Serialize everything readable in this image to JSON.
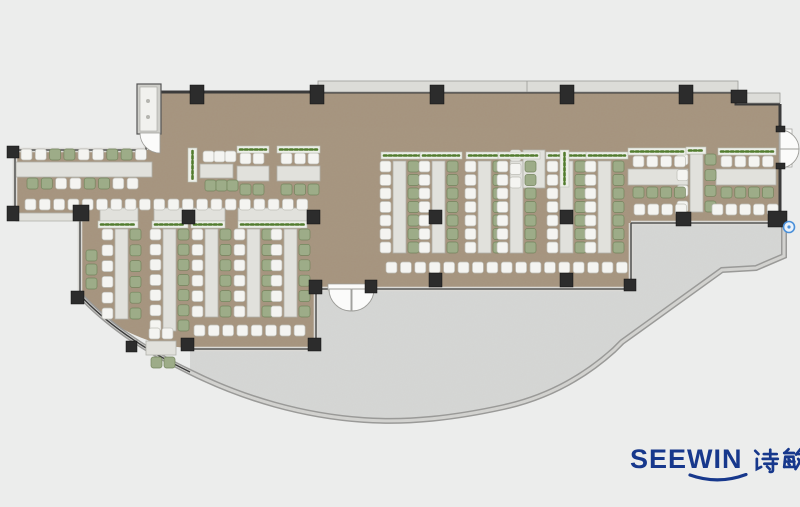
{
  "title": "Office canteen floor plan",
  "logo": {
    "brand": "SEEWIN",
    "cn": "诗敏",
    "color": "#17388c"
  },
  "plan": {
    "colors": {
      "bg": "#ecedec",
      "carpet": "#a6947e",
      "carpet_noise": "0 0 0 0 0.40  0 0 0 0 0.34  0 0 0 0 0.26  0 0 0 0.55 0",
      "terrace": "#d6d7d5",
      "terrace_noise": "0 0 0 0 0.55  0 0 0 0 0.55  0 0 0 0 0.55  0 0 0 0.28 0",
      "wall_dark": "#3b3b3b",
      "win_fill": "#dad9d5",
      "band_outer": "#9a9a98",
      "band_inner": "#d2d2cf",
      "ledge": "#dcdcd8",
      "ledge_stroke": "#9a9a96",
      "table": "#e1e1dc",
      "table_stroke": "#b1b1aa",
      "chair_w": "#f4f4f1",
      "chair_w_stroke": "#bdbdb6",
      "chair_g": "#9dac88",
      "chair_g_stroke": "#73845c",
      "planter": "#edefe9",
      "planter_stroke": "#bcc0b4",
      "plant_dots": "#527c2e",
      "column": "#2c2c2c",
      "door": "#fbfbfa",
      "door_stroke": "#9c9c98",
      "vestibule": "#cfcfca",
      "marker_ring": "#4a90d9",
      "marker_fill": "#eaf2fb"
    },
    "geometry": {
      "dining": "M160,92 L736,92 L736,104 L780,104 L780,221 L632,221 L632,287 L316,287 L316,348 L190,348 C140,346 103,320 80,295 L80,217 L15,217 L15,150 L146,150 L146,133 L160,133 Z",
      "terrace": "M190,350 L316,350 L316,289 L631,289 L631,223 L784,223 L784,256 L756,268 L722,270 L622,341 L614,349 C584,376 549,396 504,406 C454,417 409,422 364,419 C304,415 244,398 190,371 Z",
      "parapet": "M80,295 C103,320 140,348 190,372 C244,399 304,416 364,420 C409,423 454,418 504,407 C549,397 584,377 614,350 L622,342 L722,270 L756,268 L784,256 L784,222",
      "glass_curve": "M80,295 C103,320 140,348 190,372",
      "window_walls": [
        "M15,150 L146,150",
        "M15,150 L15,217",
        "M15,217 L80,217",
        "M80,217 L80,295",
        "M190,349 L316,349",
        "M316,349 L316,289",
        "M316,289 L329,289",
        "M374,289 L631,289",
        "M631,289 L631,223",
        "M631,223 L784,223",
        "M146,133 L146,150"
      ],
      "main_walls": [
        "M160,92 L736,92 L736,104 L780,104",
        "M780,104 L780,130",
        "M780,166 L780,221",
        "M160,92 L160,133"
      ],
      "ledges": [
        [
          318,
          81,
          420,
          11
        ],
        [
          737,
          93,
          43,
          10
        ]
      ],
      "ledge_seams": [
        527
      ],
      "vestibule": [
        137,
        84,
        24,
        50
      ],
      "entry_door": "M160,133 L140,133 A20,20 0 0 0 160,153 Z",
      "right_door_rect": [
        779,
        129,
        13,
        38
      ],
      "right_door_leaves": [
        "M780,130 A19,19 0 0 1 799,149 L780,149 Z",
        "M780,168 A19,19 0 0 0 799,149 L780,149 Z"
      ],
      "terrace_door_rect": [
        328,
        284,
        47,
        6
      ],
      "terrace_door_leaves": [
        "M329,289 A22,22 0 0 0 351,311 L351,289 Z",
        "M374,289 A22,22 0 0 1 352,311 L352,289 Z"
      ],
      "marker": [
        789,
        227
      ]
    },
    "furniture": {
      "vtables": [
        {
          "x": 115,
          "y": 229,
          "h": 90,
          "n": 6
        },
        {
          "x": 163,
          "y": 229,
          "h": 102,
          "n": 7
        },
        {
          "x": 205,
          "y": 229,
          "h": 88,
          "n": 6
        },
        {
          "x": 247,
          "y": 229,
          "h": 88,
          "n": 6
        },
        {
          "x": 284,
          "y": 229,
          "h": 88,
          "n": 6
        },
        {
          "x": 393,
          "y": 161,
          "h": 92,
          "n": 7
        },
        {
          "x": 432,
          "y": 161,
          "h": 92,
          "n": 7
        },
        {
          "x": 478,
          "y": 161,
          "h": 92,
          "n": 7
        },
        {
          "x": 510,
          "y": 161,
          "h": 92,
          "n": 7
        },
        {
          "x": 560,
          "y": 161,
          "h": 92,
          "n": 7
        },
        {
          "x": 598,
          "y": 161,
          "h": 92,
          "n": 7
        },
        {
          "x": 690,
          "y": 154,
          "h": 58,
          "n": 4
        },
        {
          "x": 523,
          "y": 150,
          "h": 38,
          "n": 3,
          "w": 22,
          "noright": true
        }
      ],
      "htables": [
        {
          "x": 16,
          "y": 162,
          "w": 136,
          "h": 15
        },
        {
          "x": 200,
          "y": 164,
          "w": 33,
          "h": 14
        },
        {
          "x": 237,
          "y": 166,
          "w": 32,
          "h": 15
        },
        {
          "x": 277,
          "y": 166,
          "w": 43,
          "h": 15
        },
        {
          "x": 628,
          "y": 169,
          "w": 60,
          "h": 16
        },
        {
          "x": 716,
          "y": 169,
          "w": 60,
          "h": 16
        },
        {
          "x": 100,
          "y": 208,
          "w": 38,
          "h": 13
        },
        {
          "x": 154,
          "y": 208,
          "w": 34,
          "h": 13
        },
        {
          "x": 191,
          "y": 208,
          "w": 34,
          "h": 13
        },
        {
          "x": 238,
          "y": 208,
          "w": 69,
          "h": 13
        },
        {
          "x": 16,
          "y": 213,
          "w": 70,
          "h": 8
        },
        {
          "x": 146,
          "y": 341,
          "w": 30,
          "h": 14
        }
      ],
      "planters_h": [
        {
          "x": 98,
          "y": 221,
          "w": 40
        },
        {
          "x": 152,
          "y": 221,
          "w": 36
        },
        {
          "x": 191,
          "y": 221,
          "w": 34
        },
        {
          "x": 238,
          "y": 221,
          "w": 69
        },
        {
          "x": 381,
          "y": 152,
          "w": 42
        },
        {
          "x": 420,
          "y": 152,
          "w": 42
        },
        {
          "x": 466,
          "y": 152,
          "w": 42
        },
        {
          "x": 498,
          "y": 152,
          "w": 42
        },
        {
          "x": 546,
          "y": 152,
          "w": 42
        },
        {
          "x": 586,
          "y": 152,
          "w": 42
        },
        {
          "x": 237,
          "y": 146,
          "w": 32
        },
        {
          "x": 277,
          "y": 146,
          "w": 43
        },
        {
          "x": 628,
          "y": 148,
          "w": 58
        },
        {
          "x": 718,
          "y": 148,
          "w": 58
        },
        {
          "x": 686,
          "y": 147,
          "w": 20
        }
      ],
      "planters_v": [
        {
          "x": 188,
          "y": 148,
          "h": 34
        },
        {
          "x": 560,
          "y": 150,
          "h": 37
        }
      ],
      "chair_rows": [
        {
          "x": 21,
          "y": 149,
          "colors": "wwggwwggw",
          "pitch": 14.3
        },
        {
          "x": 27,
          "y": 178,
          "colors": "ggwwggww",
          "pitch": 14.3
        },
        {
          "x": 203,
          "y": 151,
          "colors": "www",
          "pitch": 11
        },
        {
          "x": 205,
          "y": 180,
          "colors": "ggg",
          "pitch": 11
        },
        {
          "x": 240,
          "y": 153,
          "colors": "ww",
          "pitch": 13
        },
        {
          "x": 240,
          "y": 184,
          "colors": "gg",
          "pitch": 13
        },
        {
          "x": 281,
          "y": 153,
          "colors": "www",
          "pitch": 13.5
        },
        {
          "x": 281,
          "y": 184,
          "colors": "ggg",
          "pitch": 13.5
        },
        {
          "x": 25,
          "y": 199,
          "colors": "wwwwwwwwwwwwwwwwwwww",
          "pitch": 14.3
        },
        {
          "x": 633,
          "y": 156,
          "colors": "wwww",
          "pitch": 13.8
        },
        {
          "x": 633,
          "y": 187,
          "colors": "gggg",
          "pitch": 13.8
        },
        {
          "x": 634,
          "y": 204,
          "colors": "wwww",
          "pitch": 13.8
        },
        {
          "x": 721,
          "y": 156,
          "colors": "wwww",
          "pitch": 13.8
        },
        {
          "x": 721,
          "y": 187,
          "colors": "gggg",
          "pitch": 13.8
        },
        {
          "x": 712,
          "y": 204,
          "colors": "wwwww",
          "pitch": 13.8
        },
        {
          "x": 386,
          "y": 262,
          "colors": "wwwwwwwwwwwwwwwww",
          "pitch": 14.4
        },
        {
          "x": 194,
          "y": 325,
          "colors": "wwwwwwww",
          "pitch": 14.3
        },
        {
          "x": 149,
          "y": 328,
          "colors": "ww",
          "pitch": 13
        },
        {
          "x": 151,
          "y": 357,
          "colors": "gg",
          "pitch": 13
        }
      ],
      "chair_cols": [
        {
          "x": 86,
          "y": 250,
          "colors": "ggg",
          "pitch": 14
        }
      ],
      "columns": [
        [
          190,
          85,
          14,
          19
        ],
        [
          310,
          85,
          14,
          19
        ],
        [
          430,
          85,
          14,
          19
        ],
        [
          560,
          85,
          14,
          19
        ],
        [
          679,
          85,
          14,
          19
        ],
        [
          731,
          90,
          16,
          13
        ],
        [
          182,
          210,
          13,
          14
        ],
        [
          307,
          210,
          13,
          14
        ],
        [
          429,
          210,
          13,
          14
        ],
        [
          560,
          210,
          13,
          14
        ],
        [
          676,
          212,
          15,
          14
        ],
        [
          768,
          211,
          19,
          16
        ],
        [
          429,
          273,
          13,
          14
        ],
        [
          560,
          273,
          13,
          14
        ],
        [
          624,
          279,
          12,
          12
        ],
        [
          309,
          280,
          13,
          14
        ],
        [
          365,
          280,
          12,
          13
        ],
        [
          181,
          338,
          13,
          13
        ],
        [
          308,
          338,
          13,
          13
        ],
        [
          7,
          146,
          12,
          12
        ],
        [
          7,
          206,
          12,
          15
        ],
        [
          73,
          205,
          16,
          16
        ],
        [
          71,
          291,
          13,
          13
        ],
        [
          126,
          341,
          11,
          11
        ],
        [
          776,
          126,
          9,
          6
        ],
        [
          776,
          163,
          9,
          6
        ]
      ]
    }
  },
  "cn_strokes": {
    "shi": [
      "M3,3.5 L6,6.5",
      "M4.5,11 L4.5,20.5 L8.5,18.5",
      "M11,6.5 L23,6.5",
      "M17,2.5 L17,10",
      "M10,11 L24,11",
      "M11.5,15.5 L23,15.5",
      "M19.5,13 L19.5,21.5 Q19.5,23.5 16.5,23",
      "M14,18 L16.5,20.5"
    ],
    "min": [
      "M7,2 L3.5,5.5",
      "M3,5.5 L12,5.5",
      "M4.5,9 L11.5,9",
      "M4,9 L3,18.5",
      "M11.5,9 L12.5,18.5",
      "M3,18.5 L13,18.5",
      "M3.5,13.5 L12.5,13.5",
      "M7,11 L8,12",
      "M7,15.5 L8,16.5",
      "M18,2 L14,7",
      "M14.5,6.5 L24.5,6.5",
      "M20,8 C18,13 16,17 13.5,20.5",
      "M16,11 C18,15 21,18.5 24.5,20.5"
    ]
  }
}
